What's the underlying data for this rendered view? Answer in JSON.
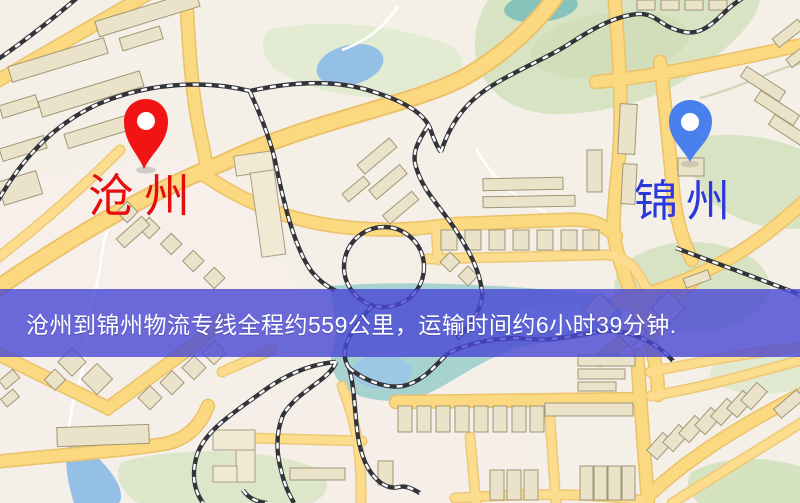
{
  "banner": {
    "text": "沧州到锦州物流专线全程约559公里，运输时间约6小时39分钟."
  },
  "route": {
    "origin": {
      "label": "沧州",
      "pin": "red-map-pin"
    },
    "destination": {
      "label": "锦州",
      "pin": "blue-map-pin"
    },
    "distance_text": "约559公里",
    "duration_text": "约6小时39分钟"
  },
  "colors": {
    "origin_label": "#e60d0d",
    "origin_pin": "#f21414",
    "destination_label": "#2b38da",
    "destination_pin": "#4a80ee",
    "banner_background": "rgba(73,71,212,0.8)",
    "banner_text": "#ffffff",
    "road": "#fbd981",
    "water": "#95c0e6",
    "park": "#d8e3c4",
    "railway": "#33333a"
  }
}
